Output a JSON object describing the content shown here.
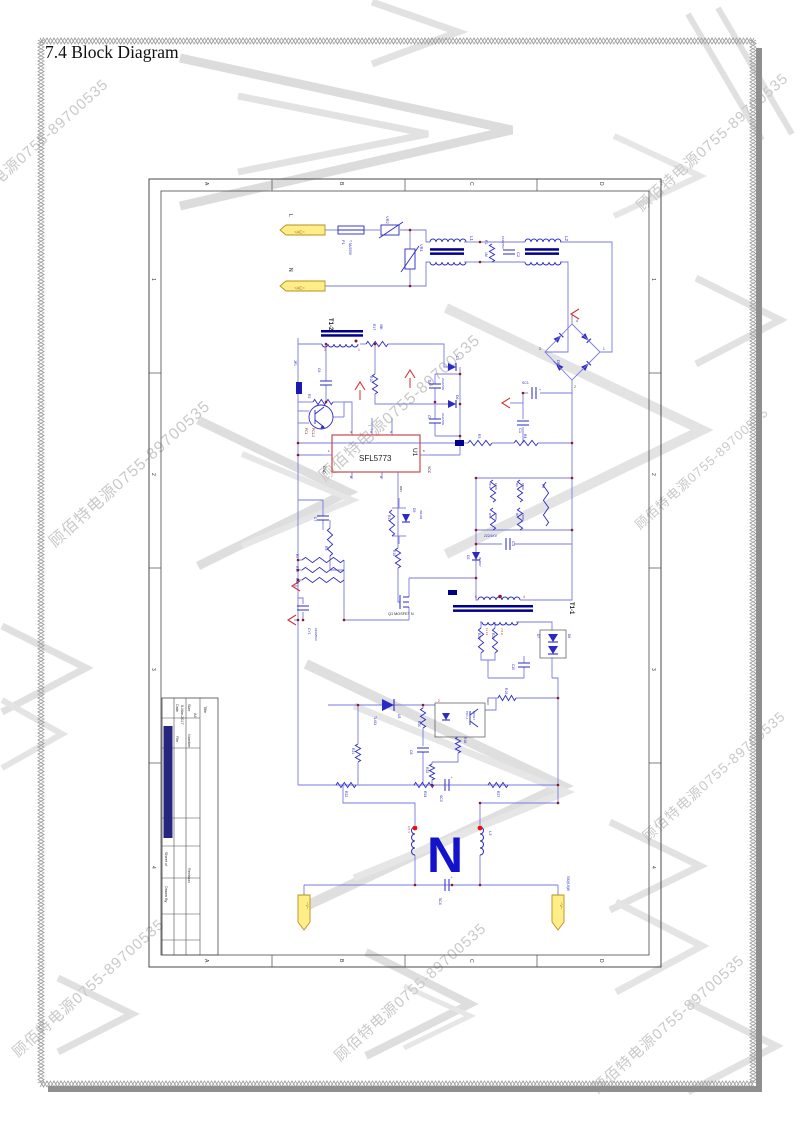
{
  "document": {
    "title": "7.4 Block Diagram"
  },
  "watermark": {
    "text": "顾佰特电源0755-89700535",
    "color": "#c9c9c9"
  },
  "sheet": {
    "zone_columns": [
      "A",
      "B",
      "C",
      "D"
    ],
    "zone_rows": [
      "1",
      "2",
      "3",
      "4"
    ],
    "title_block": {
      "fields": [
        [
          "Title",
          56,
          528
        ],
        [
          "Size",
          40,
          526
        ],
        [
          "A4",
          46,
          535
        ],
        [
          "Number",
          40,
          556
        ],
        [
          "Revision",
          40,
          690
        ],
        [
          "Date",
          28,
          526
        ],
        [
          "5-Mar-2017",
          33,
          527
        ],
        [
          "File",
          28,
          558
        ],
        [
          "Sheet of",
          17,
          674
        ],
        [
          "Drawn By",
          17,
          708
        ]
      ]
    }
  },
  "schematic": {
    "controller_part": "SFL5773",
    "colors": {
      "wire": "#7a7ae0",
      "component": "#2a2ac4",
      "bar": "#00008c",
      "junction": "#8b1a1a",
      "accent_red": "#d33030",
      "terminal_fill": "#ffee88",
      "terminal_stroke": "#b8901f",
      "u1_box": "#cc4848"
    },
    "labels": [
      [
        "line-l",
        "L",
        141,
        36,
        90,
        5,
        "k",
        0
      ],
      [
        "ac-term-1",
        "~AC~",
        146,
        55.5,
        0,
        4.2,
        "y",
        0
      ],
      [
        "line-n",
        "N",
        141,
        90,
        90,
        5,
        "k",
        0
      ],
      [
        "ac-term-2",
        "~AC~",
        146,
        111.5,
        0,
        4.2,
        "y",
        0
      ],
      [
        "f1",
        "F1",
        194,
        62,
        90,
        4,
        "b",
        0
      ],
      [
        "f1-value",
        "T 3A/250V",
        201,
        62,
        90,
        3.2,
        "b",
        0
      ],
      [
        "vr2",
        "VR2",
        238,
        38,
        90,
        4,
        "b",
        0
      ],
      [
        "vr1",
        "VR1",
        272,
        66,
        90,
        4,
        "b",
        0
      ],
      [
        "l1",
        "L1",
        322,
        58,
        90,
        4.5,
        "b",
        0
      ],
      [
        "r1",
        "R1",
        337,
        62,
        90,
        3.4,
        "b",
        0
      ],
      [
        "r1-value",
        "1M",
        337,
        74,
        90,
        3.4,
        "b",
        0
      ],
      [
        "c2-value",
        "104/275V",
        354,
        58,
        90,
        3,
        "b",
        0
      ],
      [
        "c2",
        "C2",
        369,
        74,
        90,
        4,
        "b",
        0
      ],
      [
        "l2",
        "L2",
        417,
        58,
        90,
        4.5,
        "b",
        0
      ],
      [
        "db1",
        "DB1",
        409,
        182,
        90,
        4,
        "b",
        0
      ],
      [
        "db1-pin3",
        "3",
        391,
        172,
        0,
        3.2,
        "k",
        0
      ],
      [
        "db1-pin1",
        "1",
        455,
        172,
        0,
        3.2,
        "k",
        0
      ],
      [
        "db1-pin2",
        "2",
        426,
        210,
        0,
        3.2,
        "k",
        0
      ],
      [
        "db1-pin4",
        "4",
        428,
        144,
        0,
        3.2,
        "k",
        0
      ],
      [
        "sc1",
        "SC1",
        374,
        206,
        0,
        3.5,
        "b",
        0
      ],
      [
        "sc1-plus",
        "+",
        391,
        213,
        0,
        3.5,
        "b",
        0
      ],
      [
        "c1",
        "C1",
        371,
        250,
        90,
        4,
        "b",
        0
      ],
      [
        "r3",
        "R3",
        330,
        256,
        90,
        3.4,
        "b",
        0
      ],
      [
        "r4",
        "R4",
        376,
        256,
        90,
        3.4,
        "b",
        0
      ],
      [
        "r12",
        "R12",
        341,
        305,
        90,
        3,
        "b",
        0
      ],
      [
        "r12-value",
        "100K",
        347,
        305,
        90,
        3,
        "b",
        0
      ],
      [
        "r14",
        "R14",
        341,
        335,
        90,
        3,
        "b",
        0
      ],
      [
        "r14-value",
        "300K",
        347,
        335,
        90,
        3,
        "b",
        0
      ],
      [
        "r6",
        "R6",
        368,
        305,
        90,
        3,
        "b",
        0
      ],
      [
        "r6-value",
        "150K",
        374,
        305,
        90,
        3,
        "b",
        0
      ],
      [
        "r7",
        "R7",
        368,
        335,
        90,
        3,
        "b",
        0
      ],
      [
        "r7-value",
        "150K",
        374,
        335,
        90,
        3,
        "b",
        0
      ],
      [
        "r8",
        "R8",
        394,
        306,
        90,
        3.2,
        "b",
        0
      ],
      [
        "c3-value",
        "222/1KV",
        336,
        359,
        0,
        3.4,
        "b",
        0
      ],
      [
        "c3",
        "C3",
        364,
        363,
        90,
        4,
        "b",
        0
      ],
      [
        "d2",
        "D2",
        319,
        377,
        90,
        3.4,
        "b",
        0
      ],
      [
        "d2-value",
        "IN4007",
        331,
        379,
        90,
        3,
        "b",
        0
      ],
      [
        "t1-2",
        "T1-2",
        181,
        140,
        90,
        6,
        "k",
        1
      ],
      [
        "t1-2-pin3",
        "3",
        176,
        173,
        0,
        3.4,
        "r",
        0
      ],
      [
        "t1-2-pin1",
        "1",
        210,
        173,
        0,
        3.4,
        "r",
        0
      ],
      [
        "r17",
        "R17",
        225,
        146,
        90,
        3.4,
        "b",
        0
      ],
      [
        "r17-value",
        "98K",
        232,
        146,
        90,
        3.2,
        "b",
        0
      ],
      [
        "r10",
        "R10",
        222,
        198,
        90,
        3.4,
        "b",
        0
      ],
      [
        "r2",
        "R2",
        160,
        216,
        90,
        3.4,
        "b",
        0
      ],
      [
        "d1",
        "D1",
        308,
        178,
        90,
        3.4,
        "b",
        0
      ],
      [
        "d6",
        "D6",
        308,
        217,
        90,
        3.4,
        "b",
        0
      ],
      [
        "c4",
        "C4",
        280,
        202,
        90,
        3.2,
        "b",
        0
      ],
      [
        "c4-value",
        "22uF/50V",
        294,
        200,
        90,
        2.8,
        "b",
        0
      ],
      [
        "c4-plus",
        "+",
        291,
        211,
        0,
        3,
        "b",
        0
      ],
      [
        "c5",
        "C5",
        280,
        237,
        90,
        3.2,
        "b",
        0
      ],
      [
        "c5-value",
        "22uF/50V",
        294,
        235,
        90,
        2.8,
        "b",
        0
      ],
      [
        "c5-plus",
        "+",
        291,
        246,
        0,
        3,
        "b",
        0
      ],
      [
        "jp1",
        "JP1",
        146,
        182,
        90,
        3.4,
        "b",
        0
      ],
      [
        "c6",
        "C6",
        170,
        190,
        90,
        3.4,
        "b",
        0
      ],
      [
        "pc1",
        "PC1",
        157,
        250,
        90,
        3.2,
        "d",
        0
      ],
      [
        "pc1-2",
        "PC1-2",
        164,
        250,
        90,
        3.2,
        "d",
        0
      ],
      [
        "u1-part",
        "SFL5773",
        211,
        283,
        0,
        8,
        "k",
        0
      ],
      [
        "u1",
        "U1",
        265,
        270,
        90,
        6.5,
        "k",
        0
      ],
      [
        "u1-pin1",
        "1",
        180,
        274,
        0,
        3,
        "k",
        0
      ],
      [
        "u1-gnd",
        "GND",
        175,
        288,
        90,
        3.4,
        "k",
        0
      ],
      [
        "u1-pin5",
        "5",
        275,
        274,
        0,
        3,
        "k",
        0
      ],
      [
        "u1-vcc",
        "VCC",
        280,
        288,
        90,
        3.4,
        "k",
        0
      ],
      [
        "u1-pin4",
        "4",
        202,
        255,
        0,
        3,
        "k",
        0
      ],
      [
        "u1-pin3",
        "3",
        222,
        255,
        0,
        3,
        "k",
        0
      ],
      [
        "u1-pin2",
        "2",
        242,
        255,
        0,
        3,
        "k",
        0
      ],
      [
        "u1-pin8",
        "8",
        202,
        300,
        0,
        3,
        "k",
        0
      ],
      [
        "u1-pin6",
        "6",
        232,
        300,
        0,
        3,
        "k",
        0
      ],
      [
        "u1-drv",
        "DRV",
        252,
        308,
        90,
        3,
        "k",
        0
      ],
      [
        "c7",
        "C7",
        166,
        339,
        90,
        3.4,
        "b",
        0
      ],
      [
        "r9",
        "R9",
        177,
        368,
        90,
        3.4,
        "b",
        0
      ],
      [
        "r11",
        "R11",
        240,
        337,
        90,
        3.4,
        "b",
        0
      ],
      [
        "d5",
        "D5",
        265,
        330,
        90,
        3.4,
        "b",
        0
      ],
      [
        "d5-value",
        "IN4148",
        272,
        332,
        90,
        2.8,
        "b",
        0
      ],
      [
        "r15",
        "R15",
        245,
        372,
        90,
        3.4,
        "b",
        0
      ],
      [
        "r5",
        "R5",
        148,
        376,
        90,
        3.2,
        "b",
        0
      ],
      [
        "r13",
        "R13",
        148,
        388,
        90,
        3.2,
        "b",
        0
      ],
      [
        "r16",
        "R16",
        148,
        400,
        90,
        3.2,
        "b",
        0
      ],
      [
        "q1",
        "Q1 MOSFET N",
        240,
        437,
        0,
        3.8,
        "k",
        0
      ],
      [
        "cy1",
        "CY1",
        160,
        450,
        90,
        3.4,
        "b",
        0
      ],
      [
        "cy1-value",
        "222/250V",
        167,
        450,
        90,
        3,
        "b",
        0
      ],
      [
        "t1-1",
        "T1-1",
        422,
        424,
        90,
        6,
        "k",
        1
      ],
      [
        "t1-1-pin6",
        "6",
        327,
        420,
        0,
        3.4,
        "r",
        0
      ],
      [
        "t1-1-pin4",
        "4",
        375,
        420,
        0,
        3.4,
        "r",
        0
      ],
      [
        "t1-1-sec1",
        "11 12",
        338,
        450,
        90,
        3,
        "r",
        0
      ],
      [
        "t1-1-sec2",
        "7 8 9",
        353,
        450,
        90,
        3,
        "r",
        0
      ],
      [
        "r26",
        "R26",
        330,
        455,
        90,
        3.2,
        "b",
        0
      ],
      [
        "r25",
        "R25",
        344,
        455,
        90,
        3.2,
        "b",
        0
      ],
      [
        "d7",
        "D7",
        389,
        456,
        90,
        3.2,
        "b",
        0
      ],
      [
        "d8",
        "D8",
        420,
        456,
        90,
        3.2,
        "b",
        0
      ],
      [
        "c10",
        "C10",
        364,
        486,
        90,
        3.2,
        "b",
        0
      ],
      [
        "r19",
        "R19",
        357,
        510,
        90,
        3.4,
        "b",
        0
      ],
      [
        "tl431",
        "TL431",
        226,
        538,
        90,
        3.2,
        "b",
        0
      ],
      [
        "u3",
        "U3",
        250,
        536,
        90,
        3.4,
        "b",
        0
      ],
      [
        "r20",
        "R20",
        270,
        543,
        90,
        3.4,
        "b",
        0
      ],
      [
        "c8",
        "C8",
        262,
        572,
        90,
        3.4,
        "b",
        0
      ],
      [
        "pc1-1",
        "PC1-1",
        318,
        533,
        90,
        3,
        "b",
        0
      ],
      [
        "pc817",
        "PC817",
        325,
        533,
        90,
        3,
        "b",
        0
      ],
      [
        "pc1-1-pin1",
        "1",
        339,
        524,
        0,
        3.2,
        "r",
        0
      ],
      [
        "pc1-1-pin2",
        "2",
        290,
        524,
        0,
        3.2,
        "r",
        0
      ],
      [
        "r18",
        "R18",
        316,
        559,
        90,
        3.4,
        "b",
        0
      ],
      [
        "r21",
        "R21",
        204,
        570,
        90,
        3.4,
        "b",
        0
      ],
      [
        "r23",
        "R23",
        278,
        589,
        90,
        3.4,
        "b",
        0
      ],
      [
        "r22",
        "R22",
        197,
        613,
        90,
        3.4,
        "b",
        0
      ],
      [
        "r24",
        "R24",
        276,
        613,
        90,
        3.4,
        "b",
        0
      ],
      [
        "sc3",
        "SC3",
        292,
        617,
        90,
        3.4,
        "b",
        0
      ],
      [
        "sc3-plus",
        "+",
        303,
        600,
        0,
        3,
        "b",
        0
      ],
      [
        "r27",
        "R27",
        349,
        613,
        90,
        3.4,
        "b",
        0
      ],
      [
        "logo-n",
        "N",
        297,
        694,
        0,
        50,
        "nb",
        1
      ],
      [
        "out-pins",
        "6 5 4",
        260,
        648,
        90,
        3,
        "r",
        0
      ],
      [
        "l3",
        "L3",
        341,
        653,
        90,
        4,
        "b",
        0
      ],
      [
        "sc4",
        "SC4",
        291,
        720,
        90,
        3.4,
        "b",
        0
      ],
      [
        "sc4-plus",
        "+",
        303,
        700,
        0,
        3,
        "b",
        0
      ],
      [
        "v-neg",
        "~V~",
        158,
        724,
        90,
        4,
        "y",
        0
      ],
      [
        "v-pos",
        "~V~",
        412,
        724,
        90,
        4,
        "y",
        0
      ],
      [
        "v-pos-value",
        "500(6.8)W",
        419,
        698,
        90,
        3.2,
        "b",
        0
      ]
    ]
  }
}
